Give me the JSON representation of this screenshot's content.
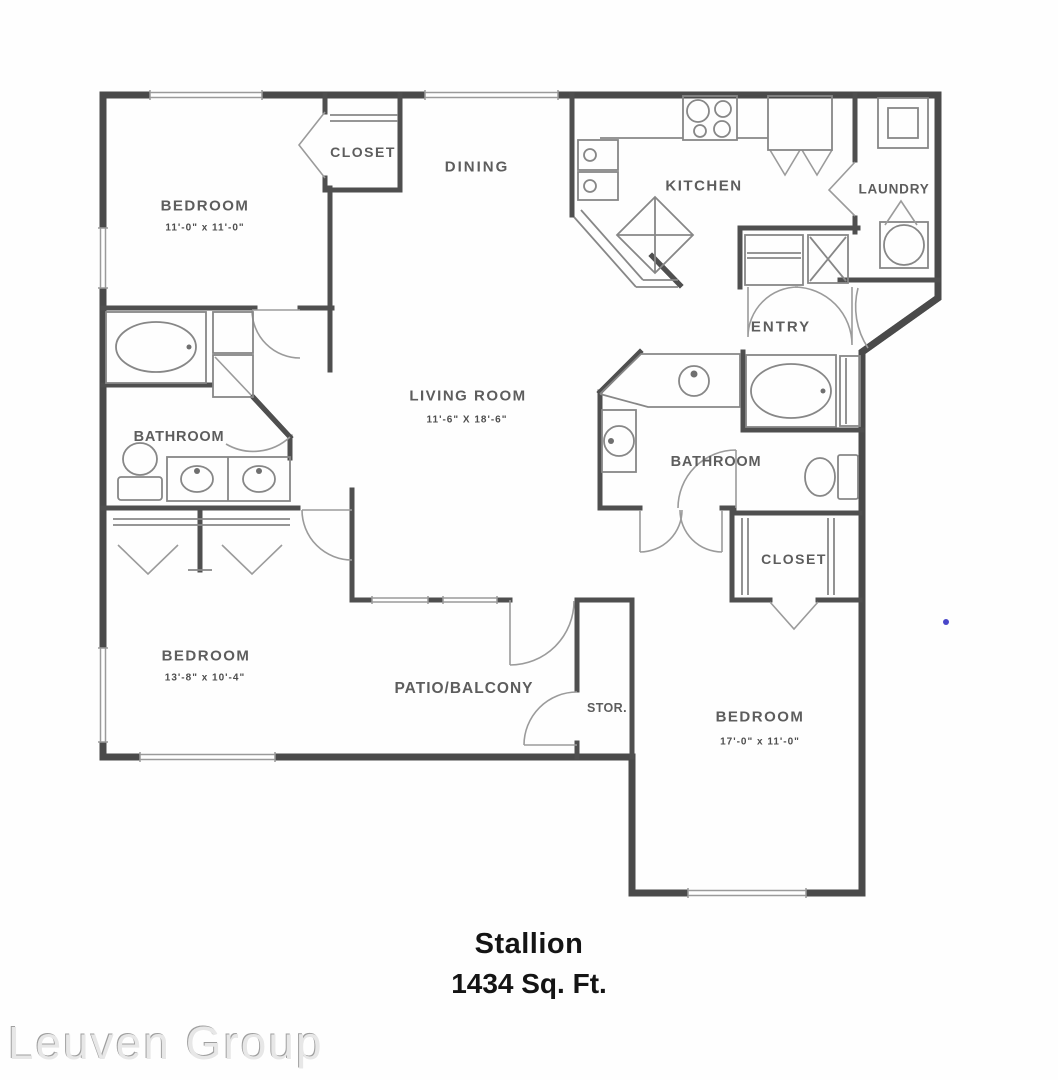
{
  "plan": {
    "title": "Stallion",
    "area": "1434 Sq. Ft.",
    "watermark": "Leuven Group",
    "rooms": {
      "bedroom1": {
        "label": "BEDROOM",
        "dims": "11'-0\" x 11'-0\""
      },
      "closet1": {
        "label": "CLOSET"
      },
      "dining": {
        "label": "DINING"
      },
      "kitchen": {
        "label": "KITCHEN"
      },
      "laundry": {
        "label": "LAUNDRY"
      },
      "entry": {
        "label": "ENTRY"
      },
      "living": {
        "label": "LIVING ROOM",
        "dims": "11'-6\" X 18'-6\""
      },
      "bathroom1": {
        "label": "BATHROOM"
      },
      "bathroom2": {
        "label": "BATHROOM"
      },
      "closet2": {
        "label": "CLOSET"
      },
      "bedroom2": {
        "label": "BEDROOM",
        "dims": "13'-8\" x 10'-4\""
      },
      "patio": {
        "label": "PATIO/BALCONY"
      },
      "storage": {
        "label": "STOR."
      },
      "bedroom3": {
        "label": "BEDROOM",
        "dims": "17'-0\" x 11'-0\""
      }
    },
    "colors": {
      "wall": "#4a4a4a",
      "fixture": "#878787",
      "label": "#5d5d5d",
      "title": "#141414",
      "watermark": "#e7e7e7",
      "accent_dot": "#4946c9"
    },
    "fixtures": [
      "bathtub-icon",
      "toilet-icon",
      "double-vanity-icon",
      "kitchen-sink-icon",
      "stove-icon",
      "pantry-icon",
      "washer-icon",
      "dryer-icon",
      "water-heater-icon",
      "closet-shelf-icon",
      "door-swing-icon",
      "bifold-door-icon",
      "window-icon"
    ]
  }
}
